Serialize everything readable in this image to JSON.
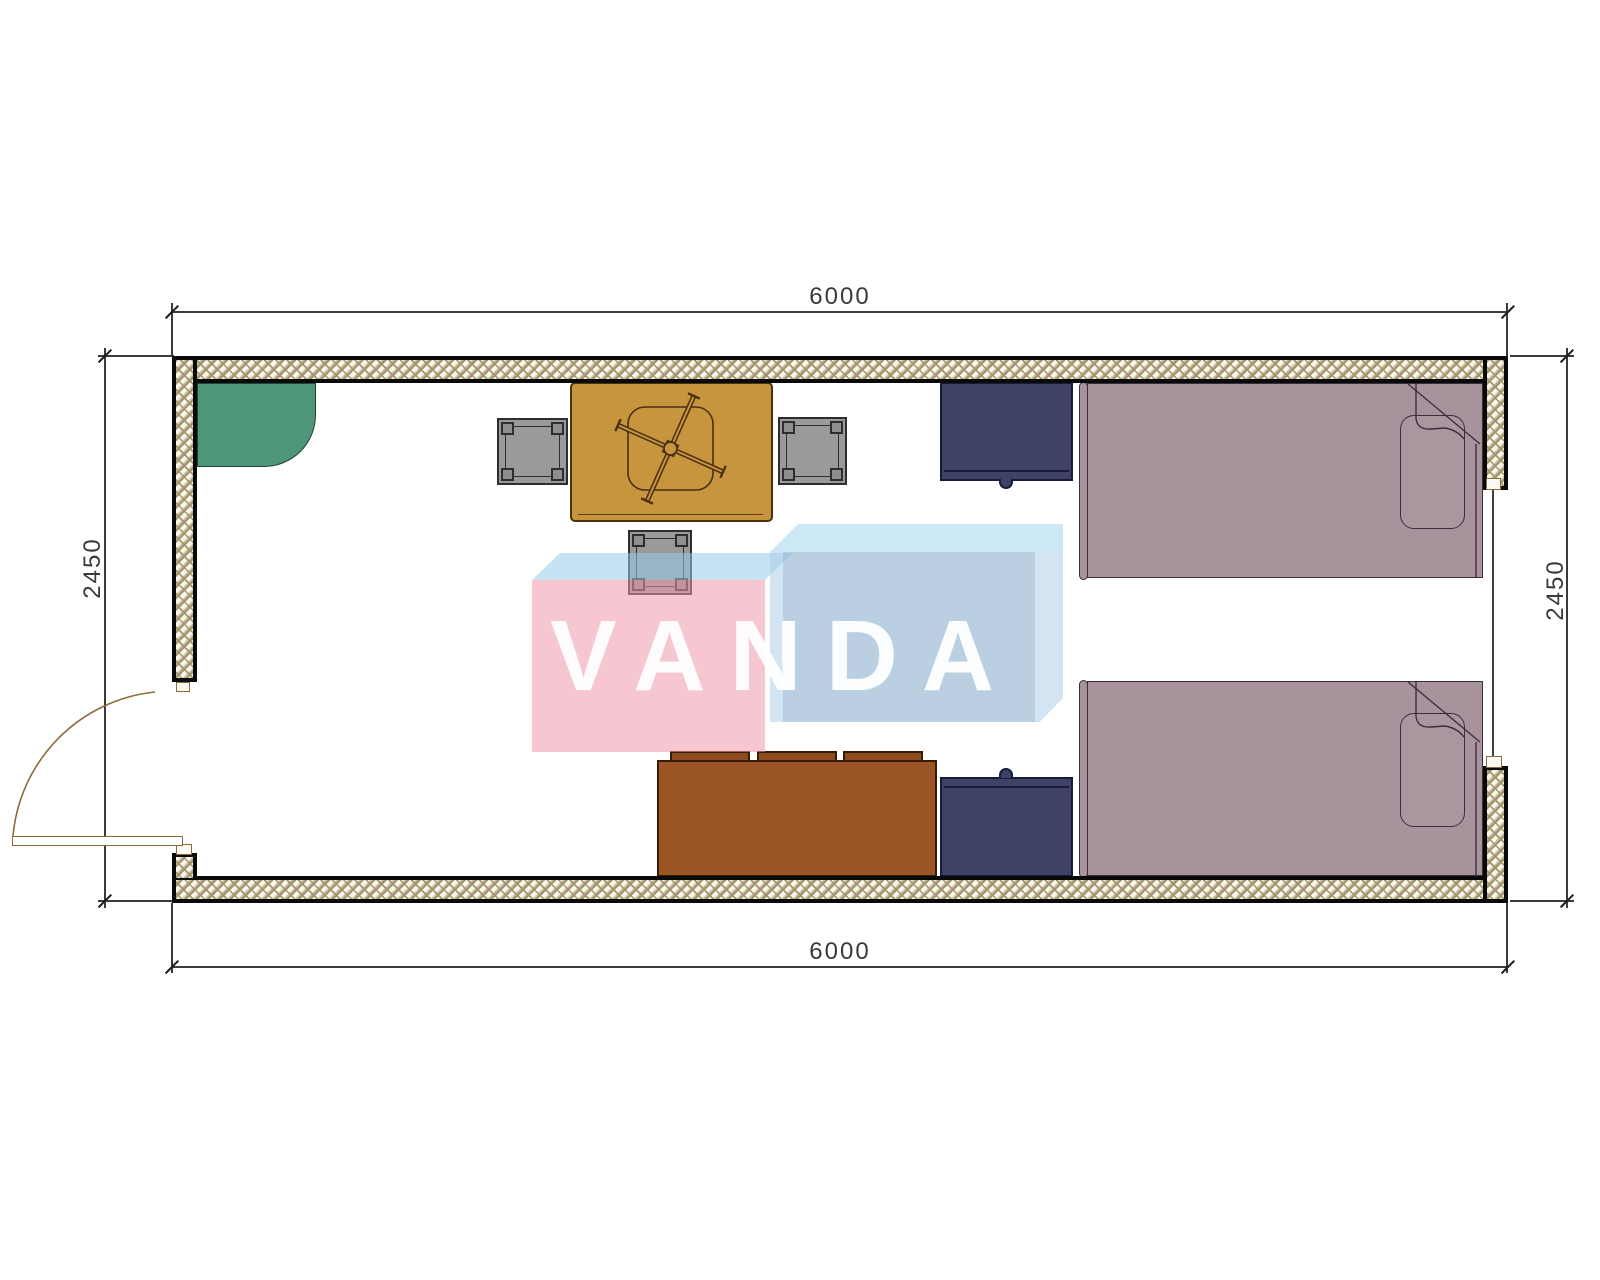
{
  "drawing": {
    "type": "floor-plan",
    "watermark_text": "VANDA"
  },
  "dimensions": {
    "top": "6000",
    "bottom": "6000",
    "left": "2450",
    "right": "2450"
  },
  "furniture_symbols": [
    {
      "icon": "corner-shelf-icon",
      "color_key": "green_unit"
    },
    {
      "icon": "table-with-ceiling-fan-icon",
      "color_key": "table"
    },
    {
      "icon": "stool-icon",
      "count": 3,
      "color_key": "stool"
    },
    {
      "icon": "nightstand-icon",
      "count": 2,
      "color_key": "nightstand"
    },
    {
      "icon": "single-bed-icon",
      "count": 2,
      "color_key": "bed"
    },
    {
      "icon": "sofa-icon",
      "color_key": "sofa"
    },
    {
      "icon": "door-swing-icon",
      "color_key": "door"
    },
    {
      "icon": "window-icon",
      "color_key": "dim"
    }
  ],
  "colors": {
    "wall_line": "#0a0a0a",
    "wall_hatch": "#a2946c",
    "wall_fill": "#fbf7ec",
    "dim": "#3a3a3a",
    "green_unit": "#4f9579",
    "table": "#c8953f",
    "table_line": "#4a330e",
    "stool": "#9a9a9a",
    "stool_post": "#8f8f8f",
    "stool_line": "#2e2e2e",
    "nightstand": "#3d4266",
    "nightstand_line": "#171c3a",
    "bed": "#a8939c",
    "pillow": "#ab96a0",
    "bed_line": "#3b2e3b",
    "sofa": "#9c5527",
    "sofa_cushion": "#8d4c1f",
    "sofa_line": "#371c07",
    "door": "#8a6c3c",
    "wm_pink": "rgba(240,153,172,0.55)",
    "wm_blue_top": "rgba(150,204,233,0.55)",
    "wm_blue_top2": "rgba(170,216,240,0.6)",
    "wm_blue": "rgba(168,203,229,0.5)",
    "wm_blue_inner": "rgba(140,168,198,0.35)",
    "wm_text": "rgba(255,255,255,0.95)"
  }
}
